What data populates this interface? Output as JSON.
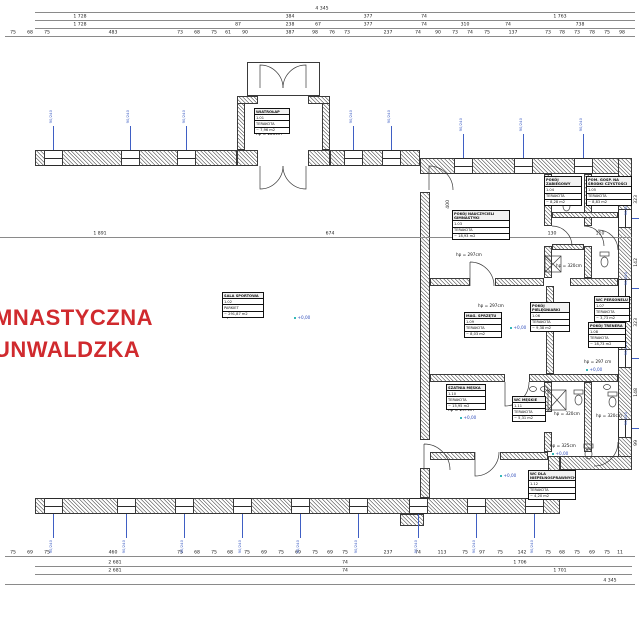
{
  "title_labels": {
    "line1": "MNASTYCZNA",
    "line2": "UNWALDZKA",
    "color": "#d02a2e"
  },
  "rooms": [
    {
      "name": "WIATROŁAP",
      "number": "1.01",
      "finish": "TERAKOTA",
      "area": "~ 7,96 m2",
      "x": 254,
      "y": 108,
      "w": 36
    },
    {
      "name": "SALA SPORTOWA",
      "number": "1.02",
      "finish": "PARKIET",
      "area": "~ 291,87 m2",
      "x": 222,
      "y": 292,
      "w": 42
    },
    {
      "name": "POKÓJ NAUCZYCIELI GIMNASTYKI",
      "number": "1.03",
      "finish": "TERAKOTA",
      "area": "~ 18,93 m2",
      "x": 452,
      "y": 210,
      "w": 58
    },
    {
      "name": "POKÓJ ZABIEGOWY",
      "number": "1.04",
      "finish": "TERAKOTA",
      "area": "~ 8,28 m2",
      "x": 544,
      "y": 176,
      "w": 38
    },
    {
      "name": "POM. GOSP. NA ŚRODKI CZYSTOŚCI",
      "number": "1.05",
      "finish": "TERAKOTA",
      "area": "~ 8,83 m2",
      "x": 586,
      "y": 176,
      "w": 46
    },
    {
      "name": "POKÓJ PIELĘGNIARKI",
      "number": "1.06",
      "finish": "TERAKOTA",
      "area": "~ 9,38 m2",
      "x": 530,
      "y": 302,
      "w": 40
    },
    {
      "name": "WC PERSONELU",
      "number": "1.07",
      "finish": "TERAKOTA",
      "area": "~ 3,73 m2",
      "x": 594,
      "y": 296,
      "w": 36
    },
    {
      "name": "POKÓJ TRENERA",
      "number": "1.08",
      "finish": "TERAKOTA",
      "area": "~ 18,73 m2",
      "x": 588,
      "y": 322,
      "w": 38
    },
    {
      "name": "MAG. SPRZĘTU",
      "number": "1.09",
      "finish": "TERAKOTA",
      "area": "~ 8,03 m2",
      "x": 464,
      "y": 312,
      "w": 38
    },
    {
      "name": "SZATNIA MĘSKA",
      "number": "1.10",
      "finish": "TERAKOTA",
      "area": "~ 15,95 m2",
      "x": 446,
      "y": 384,
      "w": 40
    },
    {
      "name": "WC MĘSKIE",
      "number": "1.11",
      "finish": "TERAKOTA",
      "area": "~ 5,31 m2",
      "x": 512,
      "y": 396,
      "w": 34
    },
    {
      "name": "WC DLA NIEPEŁNOSPRAWNYCH",
      "number": "1.12",
      "finish": "TERAKOTA",
      "area": "~ 4,20 m2",
      "x": 528,
      "y": 470,
      "w": 48
    }
  ],
  "notes": [
    {
      "t": "hp = 226cm",
      "x": 256,
      "y": 132
    },
    {
      "t": "hp = 576cm",
      "x": 224,
      "y": 315
    },
    {
      "t": "hp = 297cm",
      "x": 456,
      "y": 253
    },
    {
      "t": "hp = 320cm",
      "x": 556,
      "y": 194
    },
    {
      "t": "hp = 320cm",
      "x": 596,
      "y": 194
    },
    {
      "t": "hp = 320cm",
      "x": 556,
      "y": 264
    },
    {
      "t": "hp = 297cm",
      "x": 478,
      "y": 304
    },
    {
      "t": "hp = 297 cm",
      "x": 584,
      "y": 360
    },
    {
      "t": "hp = 297cm",
      "x": 448,
      "y": 408
    },
    {
      "t": "hp = 320cm",
      "x": 554,
      "y": 412
    },
    {
      "t": "hp = 320cm",
      "x": 596,
      "y": 414
    },
    {
      "t": "hp = 325cm",
      "x": 550,
      "y": 444
    }
  ],
  "levels": [
    {
      "t": "+0,00",
      "x": 294,
      "y": 316
    },
    {
      "t": "+0,00",
      "x": 472,
      "y": 234
    },
    {
      "t": "+0,00",
      "x": 510,
      "y": 326
    },
    {
      "t": "+0,00",
      "x": 586,
      "y": 368
    },
    {
      "t": "+0,00",
      "x": 460,
      "y": 416
    },
    {
      "t": "+0,00",
      "x": 552,
      "y": 452
    },
    {
      "t": "+0,00",
      "x": 500,
      "y": 474
    }
  ],
  "window_mark_label": "90/240",
  "window_marks": [
    {
      "o": "v",
      "lx": 53,
      "ly": 126,
      "ll": 24,
      "tx": 49,
      "ty": 110
    },
    {
      "o": "v",
      "lx": 130,
      "ly": 126,
      "ll": 24,
      "tx": 126,
      "ty": 110
    },
    {
      "o": "v",
      "lx": 186,
      "ly": 126,
      "ll": 24,
      "tx": 182,
      "ty": 110
    },
    {
      "o": "v",
      "lx": 353,
      "ly": 126,
      "ll": 24,
      "tx": 349,
      "ty": 110
    },
    {
      "o": "v",
      "lx": 391,
      "ly": 126,
      "ll": 24,
      "tx": 387,
      "ty": 110
    },
    {
      "o": "v",
      "lx": 463,
      "ly": 134,
      "ll": 24,
      "tx": 459,
      "ty": 118
    },
    {
      "o": "v",
      "lx": 523,
      "ly": 134,
      "ll": 24,
      "tx": 519,
      "ty": 118
    },
    {
      "o": "v",
      "lx": 583,
      "ly": 134,
      "ll": 24,
      "tx": 579,
      "ty": 118
    },
    {
      "o": "v",
      "lx": 53,
      "ly": 514,
      "ll": 24,
      "tx": 49,
      "ty": 540
    },
    {
      "o": "v",
      "lx": 126,
      "ly": 514,
      "ll": 24,
      "tx": 122,
      "ty": 540
    },
    {
      "o": "v",
      "lx": 184,
      "ly": 514,
      "ll": 24,
      "tx": 180,
      "ty": 540
    },
    {
      "o": "v",
      "lx": 242,
      "ly": 514,
      "ll": 24,
      "tx": 238,
      "ty": 540
    },
    {
      "o": "v",
      "lx": 300,
      "ly": 514,
      "ll": 24,
      "tx": 296,
      "ty": 540
    },
    {
      "o": "v",
      "lx": 358,
      "ly": 514,
      "ll": 24,
      "tx": 354,
      "ty": 540
    },
    {
      "o": "v",
      "lx": 418,
      "ly": 514,
      "ll": 24,
      "tx": 414,
      "ty": 540
    },
    {
      "o": "v",
      "lx": 476,
      "ly": 514,
      "ll": 24,
      "tx": 472,
      "ty": 540
    },
    {
      "o": "v",
      "lx": 534,
      "ly": 514,
      "ll": 24,
      "tx": 530,
      "ty": 540
    },
    {
      "o": "h",
      "lx": 632,
      "ly": 218,
      "ll": 7,
      "tx": 624,
      "ty": 202
    },
    {
      "o": "h",
      "lx": 632,
      "ly": 288,
      "ll": 7,
      "tx": 624,
      "ty": 272
    },
    {
      "o": "h",
      "lx": 632,
      "ly": 358,
      "ll": 7,
      "tx": 624,
      "ty": 342
    },
    {
      "o": "h",
      "lx": 632,
      "ly": 428,
      "ll": 7,
      "tx": 624,
      "ty": 412
    }
  ],
  "dimensions": {
    "rows": [
      {
        "y": 12,
        "x1": 35,
        "x2": 635,
        "labels": [
          {
            "x": 322,
            "t": "4 345"
          }
        ]
      },
      {
        "y": 20,
        "x1": 35,
        "x2": 635,
        "labels": [
          {
            "x": 80,
            "t": "1 728"
          },
          {
            "x": 290,
            "t": "384"
          },
          {
            "x": 368,
            "t": "377"
          },
          {
            "x": 424,
            "t": "74"
          },
          {
            "x": 560,
            "t": "1 763"
          }
        ]
      },
      {
        "y": 28,
        "x1": 35,
        "x2": 635,
        "labels": [
          {
            "x": 80,
            "t": "1 728"
          },
          {
            "x": 238,
            "t": "87"
          },
          {
            "x": 290,
            "t": "238"
          },
          {
            "x": 318,
            "t": "67"
          },
          {
            "x": 368,
            "t": "377"
          },
          {
            "x": 424,
            "t": "74"
          },
          {
            "x": 465,
            "t": "310"
          },
          {
            "x": 508,
            "t": "74"
          },
          {
            "x": 580,
            "t": "738"
          }
        ]
      },
      {
        "y": 36,
        "x1": 5,
        "x2": 635,
        "labels": [
          {
            "x": 13,
            "t": "75"
          },
          {
            "x": 30,
            "t": "68"
          },
          {
            "x": 47,
            "t": "75"
          },
          {
            "x": 113,
            "t": "483"
          },
          {
            "x": 180,
            "t": "73"
          },
          {
            "x": 197,
            "t": "68"
          },
          {
            "x": 214,
            "t": "75"
          },
          {
            "x": 228,
            "t": "61"
          },
          {
            "x": 245,
            "t": "90"
          },
          {
            "x": 290,
            "t": "387"
          },
          {
            "x": 315,
            "t": "98"
          },
          {
            "x": 332,
            "t": "76"
          },
          {
            "x": 347,
            "t": "73"
          },
          {
            "x": 388,
            "t": "237"
          },
          {
            "x": 418,
            "t": "74"
          },
          {
            "x": 438,
            "t": "90"
          },
          {
            "x": 455,
            "t": "73"
          },
          {
            "x": 470,
            "t": "74"
          },
          {
            "x": 487,
            "t": "75"
          },
          {
            "x": 513,
            "t": "137"
          },
          {
            "x": 548,
            "t": "73"
          },
          {
            "x": 562,
            "t": "78"
          },
          {
            "x": 577,
            "t": "73"
          },
          {
            "x": 592,
            "t": "78"
          },
          {
            "x": 607,
            "t": "75"
          },
          {
            "x": 622,
            "t": "98"
          }
        ]
      },
      {
        "y": 556,
        "x1": 5,
        "x2": 635,
        "labels": [
          {
            "x": 13,
            "t": "75"
          },
          {
            "x": 30,
            "t": "69"
          },
          {
            "x": 47,
            "t": "75"
          },
          {
            "x": 113,
            "t": "460"
          },
          {
            "x": 180,
            "t": "75"
          },
          {
            "x": 197,
            "t": "68"
          },
          {
            "x": 214,
            "t": "75"
          },
          {
            "x": 230,
            "t": "68"
          },
          {
            "x": 247,
            "t": "75"
          },
          {
            "x": 264,
            "t": "69"
          },
          {
            "x": 281,
            "t": "75"
          },
          {
            "x": 298,
            "t": "69"
          },
          {
            "x": 315,
            "t": "75"
          },
          {
            "x": 330,
            "t": "69"
          },
          {
            "x": 345,
            "t": "75"
          },
          {
            "x": 388,
            "t": "237"
          },
          {
            "x": 418,
            "t": "74"
          },
          {
            "x": 442,
            "t": "113"
          },
          {
            "x": 465,
            "t": "75"
          },
          {
            "x": 482,
            "t": "97"
          },
          {
            "x": 500,
            "t": "75"
          },
          {
            "x": 522,
            "t": "142"
          },
          {
            "x": 548,
            "t": "75"
          },
          {
            "x": 562,
            "t": "68"
          },
          {
            "x": 577,
            "t": "75"
          },
          {
            "x": 592,
            "t": "69"
          },
          {
            "x": 607,
            "t": "75"
          },
          {
            "x": 620,
            "t": "11"
          }
        ]
      },
      {
        "y": 566,
        "x1": 35,
        "x2": 632,
        "labels": [
          {
            "x": 115,
            "t": "2 681"
          },
          {
            "x": 345,
            "t": "74"
          },
          {
            "x": 520,
            "t": "1 706"
          }
        ]
      },
      {
        "y": 574,
        "x1": 35,
        "x2": 632,
        "labels": [
          {
            "x": 115,
            "t": "2 681"
          },
          {
            "x": 345,
            "t": "74"
          },
          {
            "x": 560,
            "t": "1 701"
          }
        ]
      },
      {
        "y": 584,
        "x1": 5,
        "x2": 635,
        "labels": [
          {
            "x": 610,
            "t": "4 345"
          }
        ]
      },
      {
        "y": 237,
        "x1": 0,
        "x2": 632,
        "labels": [
          {
            "x": 100,
            "t": "1 891"
          },
          {
            "x": 330,
            "t": "674"
          },
          {
            "x": 470,
            "t": "340"
          },
          {
            "x": 552,
            "t": "130"
          },
          {
            "x": 600,
            "t": "110"
          }
        ]
      }
    ],
    "vertical": [
      {
        "x": 446,
        "y": 200,
        "t": "400"
      },
      {
        "x": 634,
        "y": 195,
        "t": "323"
      },
      {
        "x": 634,
        "y": 258,
        "t": "142"
      },
      {
        "x": 634,
        "y": 318,
        "t": "323"
      },
      {
        "x": 634,
        "y": 388,
        "t": "148"
      },
      {
        "x": 634,
        "y": 440,
        "t": "99"
      }
    ]
  }
}
